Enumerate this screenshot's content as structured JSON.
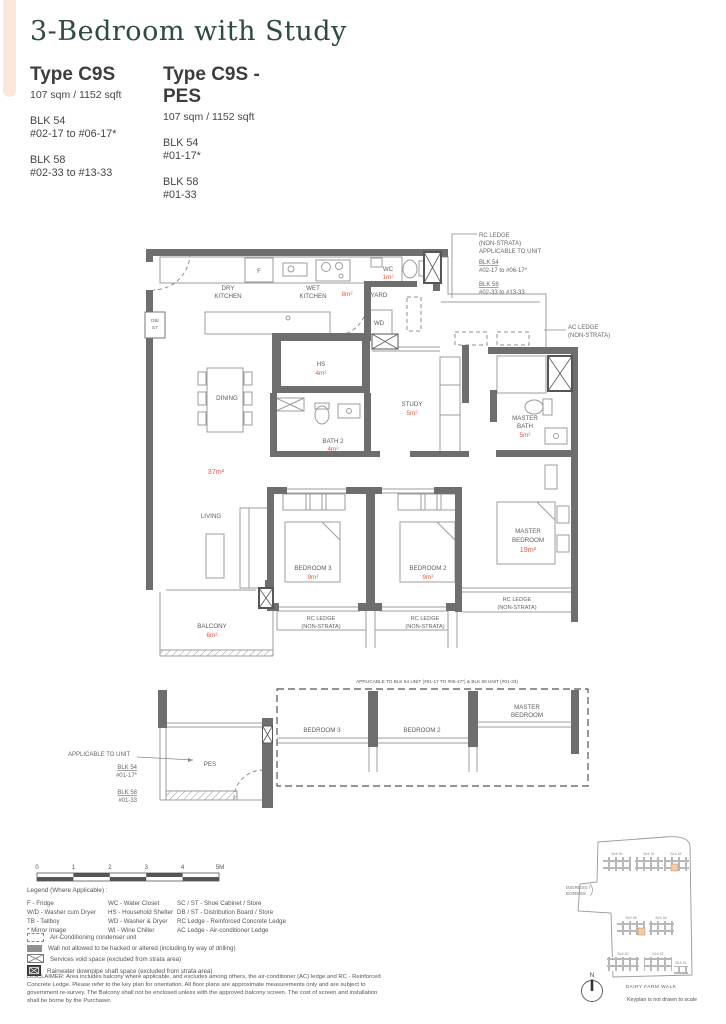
{
  "colors": {
    "accent_green": "#2d4b41",
    "area_red": "#e15b45",
    "wall_gray": "#6e6e6e",
    "peach_bar": "#fbe7da",
    "keyplan_highlight": "#f2cba9"
  },
  "header": {
    "title": "3-Bedroom with Study",
    "left": {
      "name": "Type C9S",
      "area": "107 sqm / 1152 sqft",
      "blk1": "BLK 54",
      "blk1_units": "#02-17 to #06-17*",
      "blk2": "BLK 58",
      "blk2_units": "#02-33 to #13-33"
    },
    "right": {
      "name": "Type C9S - PES",
      "area": "107 sqm / 1152 sqft",
      "blk1": "BLK 54",
      "blk1_units": "#01-17*",
      "blk2": "BLK 58",
      "blk2_units": "#01-33"
    }
  },
  "plan": {
    "dry_l1": "DRY",
    "dry_l2": "KITCHEN",
    "wet_l1": "WET",
    "wet_l2": "KITCHEN",
    "wet_area": "8m²",
    "wc": "WC",
    "wc_area": "1m²",
    "yard": "YARD",
    "wd": "WD",
    "db_l1": "DB/",
    "db_l2": "ST",
    "fridge": "F",
    "hs": "HS",
    "hs_area": "4m²",
    "dining": "DINING",
    "living": "LIVING",
    "living_area": "37m²",
    "study": "STUDY",
    "study_area": "5m²",
    "bath2": "BATH 2",
    "bath2_area": "4m²",
    "mbath_l1": "MASTER",
    "mbath_l2": "BATH",
    "mbath_area": "5m²",
    "bed3": "BEDROOM 3",
    "bed3_area": "9m²",
    "bed2": "BEDROOM 2",
    "bed2_area": "9m²",
    "mbed_l1": "MASTER",
    "mbed_l2": "BEDROOM",
    "mbed_area": "19m²",
    "balcony": "BALCONY",
    "balcony_area": "6m²",
    "rc_l1": "RC LEDGE",
    "rc_l2": "(NON-STRATA)"
  },
  "notes": {
    "rc_l1": "RC LEDGE",
    "rc_l2": "(NON-STRATA)",
    "rc_l3": "APPLICABLE TO UNIT",
    "rc_blk1": "BLK 54",
    "rc_blk1_units": "#02-17 to #06-17*",
    "rc_blk2": "BLK 58",
    "rc_blk2_units": "#02-33 to #13-33",
    "ac_l1": "AC LEDGE",
    "ac_l2": "(NON-STRATA)"
  },
  "pes": {
    "top_note": "APPLICABLE TO BLK 54 UNIT (#01-17 TO #06-17*) & BLK 58 UNIT (#01-33)",
    "left_title": "APPLICABLE TO UNIT",
    "left_blk1": "BLK 54",
    "left_blk1_units": "#01-17*",
    "left_blk2": "BLK 58",
    "left_blk2_units": "#01-33",
    "label": "PES",
    "bed3": "BEDROOM 3",
    "bed2": "BEDROOM 2",
    "master_l1": "MASTER",
    "master_l2": "BEDROOM"
  },
  "scale": {
    "labels": [
      "0",
      "1",
      "2",
      "3",
      "4",
      "5M"
    ]
  },
  "legend": {
    "title": "Legend (Where Applicable) :",
    "col1": [
      "F - Fridge",
      "W/D - Washer cum Dryer",
      "TB - Tallboy",
      "* Mirror Image"
    ],
    "col2": [
      "WC - Water Closet",
      "HS - Household Shelter",
      "WD - Washer & Dryer",
      "WI - Wine Chiller"
    ],
    "col3": [
      "SC / ST - Shoe Cabinet / Store",
      "DB / ST - Distribution Board / Store",
      "RC Ledge - Reinforced Concrete Ledge",
      "AC Ledge - Air-conditioner Ledge"
    ],
    "symbols": [
      "Air-Conditioning condenser unit",
      "Wall not allowed to be hacked or altered (including by way of drilling)",
      "Services void space (excluded from strata area)",
      "Rainwater downpipe shaft space (excluded from strata area)"
    ]
  },
  "disclaimer": "DISCLAIMER: Area includes balcony where applicable, and excludes among others, the air-conditioner (AC) ledge and RC - Reinforced Concrete Ledge. Please refer to the key plan for orientation. All floor plans are approximate measurements only and are subject to government re-survey. The Balcony shall not be enclosed unless with the approved balcony screen. The cost of screen and installation shall be borne by the Purchaser.",
  "keyplan": {
    "blocks": [
      "BLK 50",
      "BLK 52",
      "BLK 54",
      "BLK 58",
      "BLK 56",
      "BLK 60",
      "BLK 62",
      "BLK 64"
    ],
    "ingress_l1": "INGRESS /",
    "ingress_l2": "EGRESS",
    "north": "N",
    "street": "DAIRY FARM WALK",
    "note": "Keyplan is not drawn to scale"
  }
}
